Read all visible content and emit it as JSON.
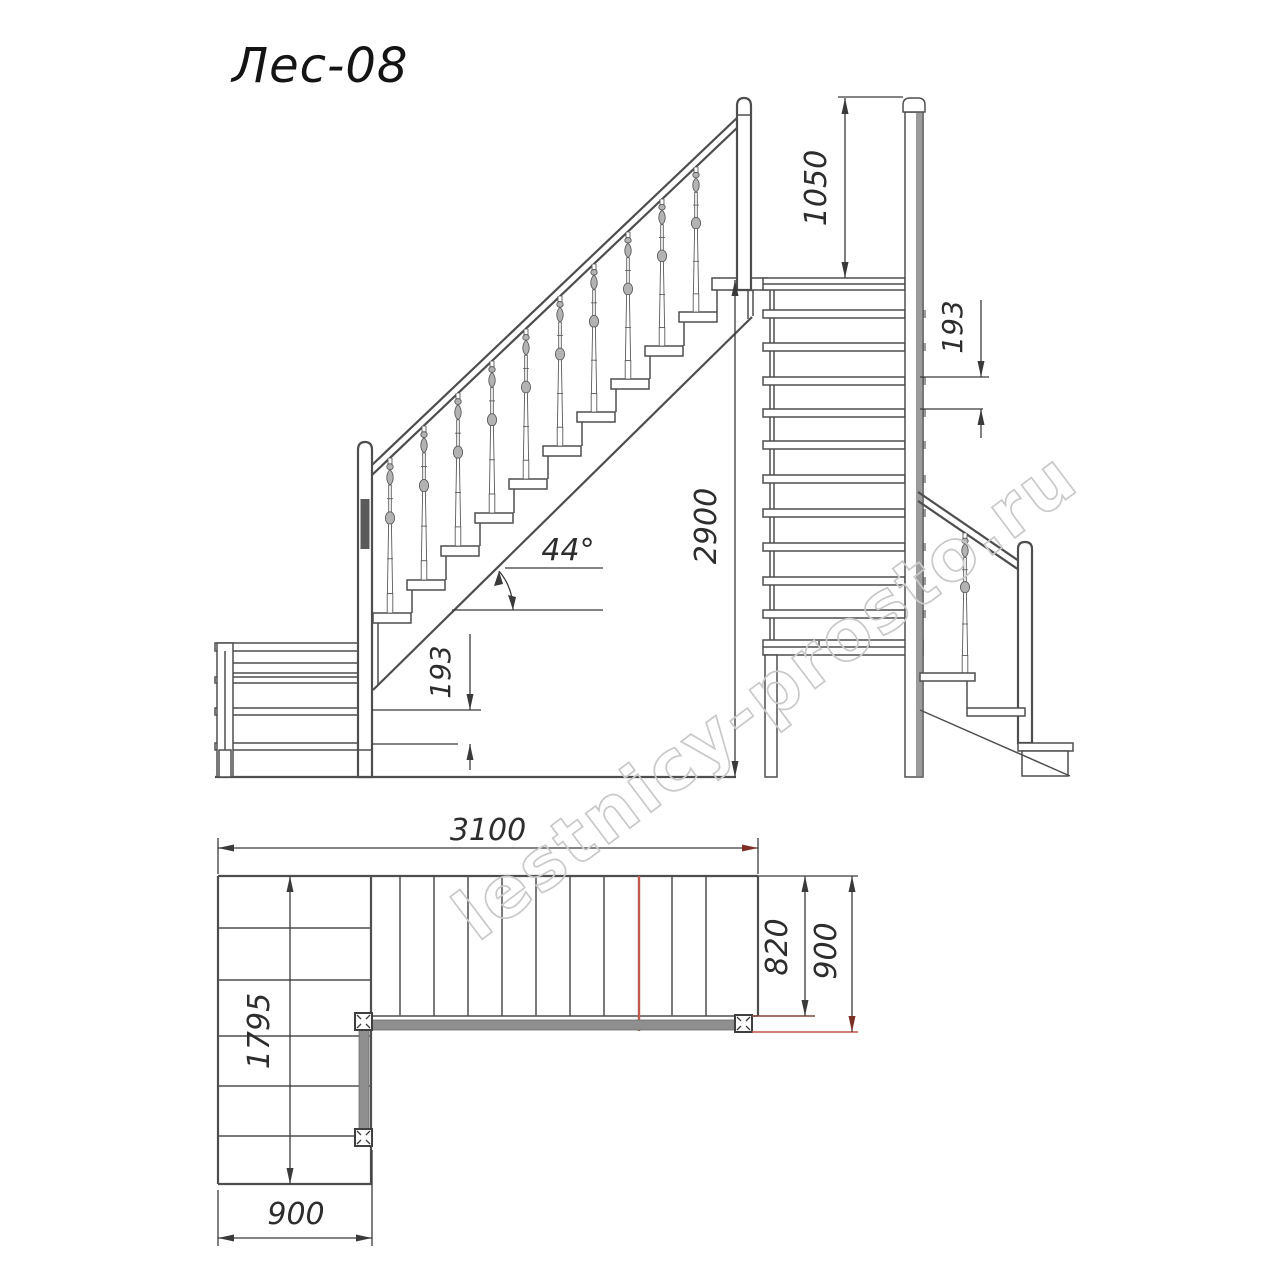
{
  "title": "Лес-08",
  "watermark": "lestnicy-prosto.ru",
  "drawing": {
    "type": "staircase technical blueprint, three orthographic views (side elevation, front view, plan view)",
    "views": {
      "side_elevation": {
        "angle_label": "44°",
        "total_rise_label": "2900",
        "riser_label": "193"
      },
      "front_view": {
        "rail_height_label": "1050",
        "riser_label": "193"
      },
      "plan_view": {
        "total_length_label": "3100",
        "clear_width_label": "820",
        "flight_width_label": "900",
        "lower_flight_length_label": "1795",
        "lower_flight_width_label": "900"
      }
    },
    "colors": {
      "line": "#4e4e4e",
      "dimension": "#3a3a3a",
      "gray_fill": "#8f8f8f",
      "red_line": "#c05a4e",
      "dark_red_arrow": "#7c2f23",
      "watermark": "#c9c9c9"
    }
  }
}
